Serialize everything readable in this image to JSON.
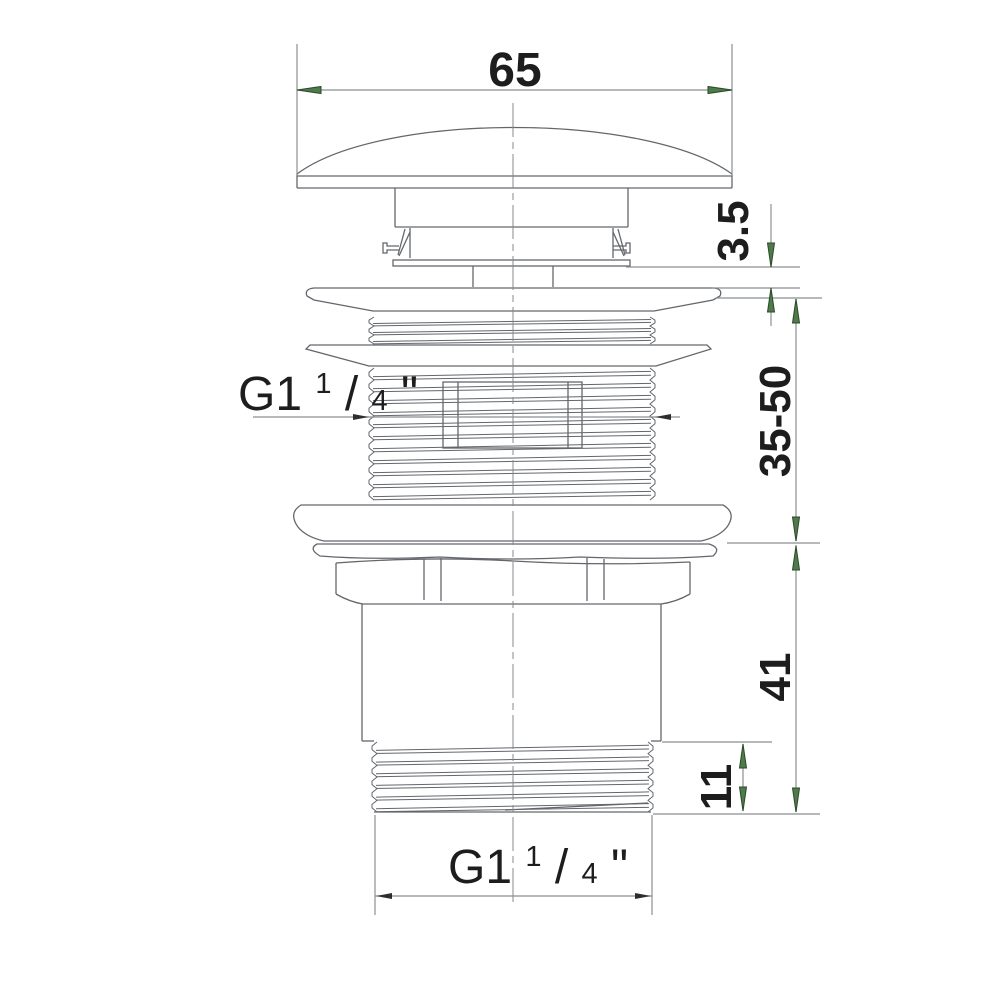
{
  "drawing": {
    "dimensions": {
      "cap_diameter": "65",
      "flange_thickness": "3.5",
      "clamping_range": "35-50",
      "body_height": "41",
      "thread_length": "11"
    },
    "thread_labels": {
      "side": {
        "prefix": "G1",
        "sup": "1",
        "slash": "/",
        "den": "4",
        "quote": "\""
      },
      "bottom": {
        "prefix": "G1",
        "sup": "1",
        "slash": "/",
        "den": "4",
        "quote": "\""
      }
    },
    "colors": {
      "background": "#ffffff",
      "line": "#63676c",
      "dim_line": "#8b8f93",
      "text": "#1d1d1d",
      "arrow_fill": "#4e7b4b",
      "arrow_stroke": "#2c4a29"
    }
  }
}
